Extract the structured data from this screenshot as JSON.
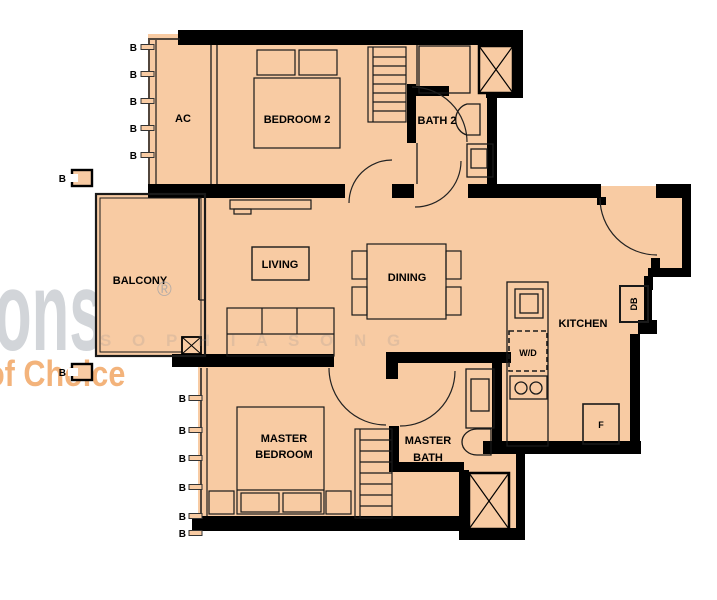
{
  "title": "apartment-floor-plan",
  "colors": {
    "floor": "#f8cba3",
    "wall": "#000000",
    "watermark_gray": "#d2d5d9",
    "watermark_orange": "#ef9a50"
  },
  "watermark": {
    "logo": "ons",
    "registered": "®",
    "tagline": "of Choice",
    "letters": "S O P H I A   S O N G"
  },
  "rooms": {
    "ac": "AC",
    "bedroom2": "BEDROOM 2",
    "bath2": "BATH 2",
    "balcony": "BALCONY",
    "living": "LIVING",
    "dining": "DINING",
    "kitchen": "KITCHEN",
    "master_bedroom_line1": "MASTER",
    "master_bedroom_line2": "BEDROOM",
    "master_bath_line1": "MASTER",
    "master_bath_line2": "BATH"
  },
  "fixtures": {
    "washer_dryer": "W/D",
    "distribution_board": "DB",
    "fridge": "F"
  },
  "markers": {
    "beam": "B"
  }
}
